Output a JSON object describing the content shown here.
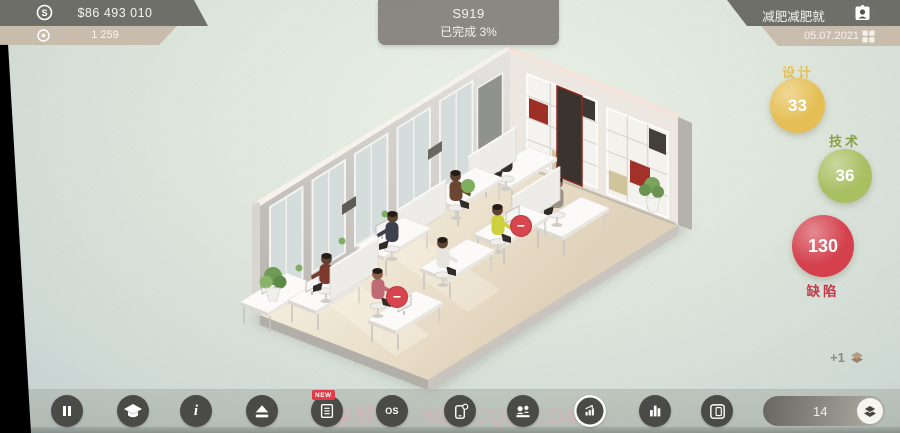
{
  "header": {
    "money": {
      "value": "$86 493 010",
      "icon": "dollar-circle-icon"
    },
    "research": {
      "value": "1 259",
      "icon": "research-coin-icon"
    },
    "project": {
      "name": "S919",
      "status": "已完成 3%"
    },
    "company": {
      "name": "减肥减肥就",
      "icon": "id-badge-icon"
    },
    "date": {
      "value": "05.07.2021",
      "icon": "grid-menu-icon"
    }
  },
  "stats": {
    "design": {
      "label": "设计",
      "value": "33",
      "color": "#e5bf55"
    },
    "tech": {
      "label": "技术",
      "value": "36",
      "color": "#a8bf62"
    },
    "defects": {
      "label": "缺陷",
      "value": "130",
      "color": "#d4414d"
    }
  },
  "scene": {
    "xp_gain": "+1",
    "xp_icon": "floors-stack-icon",
    "defect_badge_symbol": "−"
  },
  "watermark": "乐享轻汇 · NDYCQH.COM",
  "toolbar": {
    "new_badge": "NEW",
    "os_label": "OS",
    "floor": {
      "value": "14",
      "icon": "floors-stack-icon"
    },
    "buttons": [
      "pause",
      "graduation-cap",
      "info",
      "eject-up",
      "news-list",
      "os",
      "phone-notification",
      "staff",
      "growth-stats",
      "bar-chart",
      "tablet-device"
    ]
  }
}
